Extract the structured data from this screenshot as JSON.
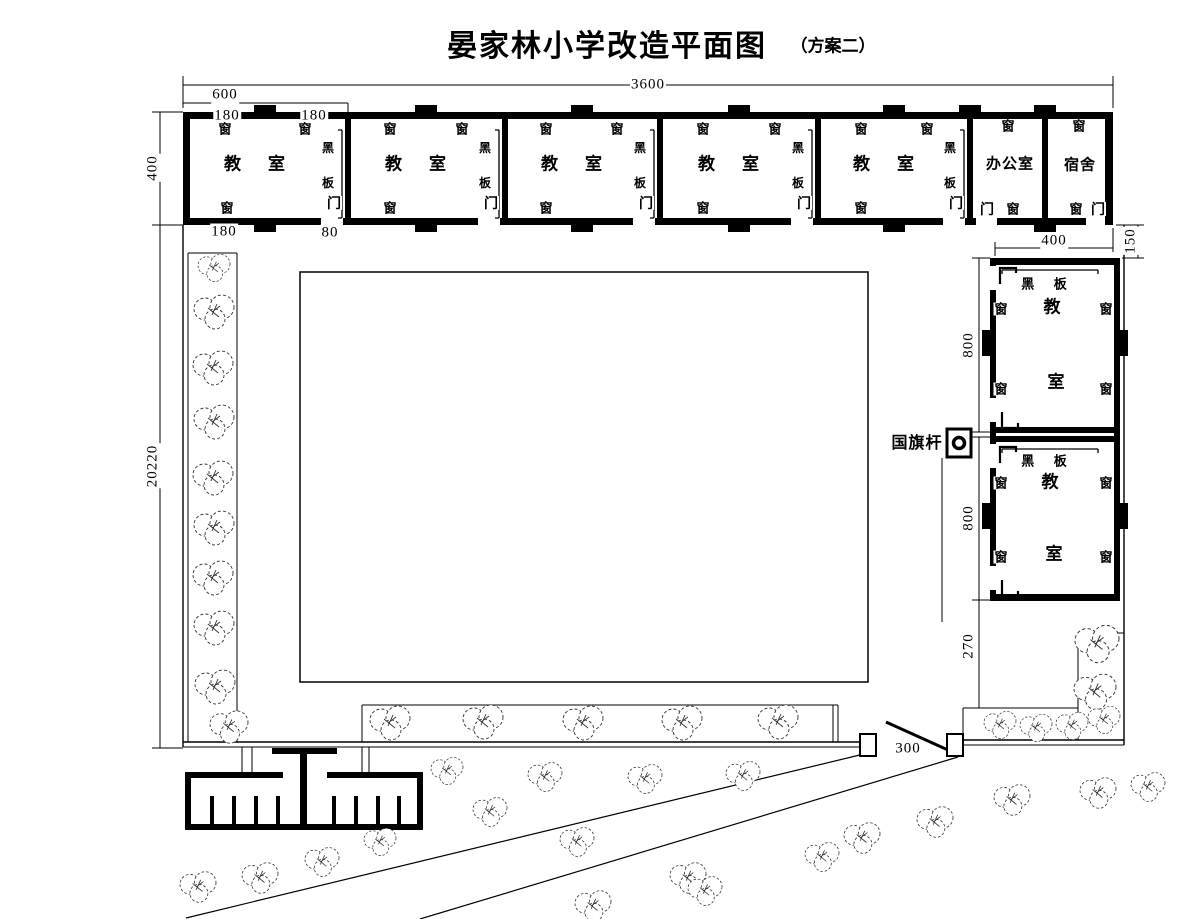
{
  "title": {
    "main": "晏家林小学改造平面图",
    "sub": "（方案二）"
  },
  "labels": {
    "window": "窗",
    "door": "门",
    "blackboard": "黑 板",
    "blackboard_char1": "黑",
    "blackboard_char2": "板",
    "classroom_char1": "教",
    "classroom_char2": "室",
    "flagpole": "国旗杆"
  },
  "rooms": {
    "top_row": [
      "教室",
      "教室",
      "教室",
      "教室",
      "教室",
      "办公室",
      "宿舍"
    ],
    "right_column": [
      "教室",
      "教室"
    ]
  },
  "dimensions": {
    "total_width": "3600",
    "room_width": "600",
    "win_left": "180",
    "win_right": "180",
    "depth": "400",
    "bottom_window": "180",
    "door": "80",
    "site_height": "20220",
    "right_width": "400",
    "right_gap": "150",
    "right_room1": "800",
    "right_room2": "800",
    "right_offset": "270",
    "gate": "300"
  },
  "colors": {
    "line": "#000000",
    "background": "#ffffff",
    "tree": "#333333"
  }
}
